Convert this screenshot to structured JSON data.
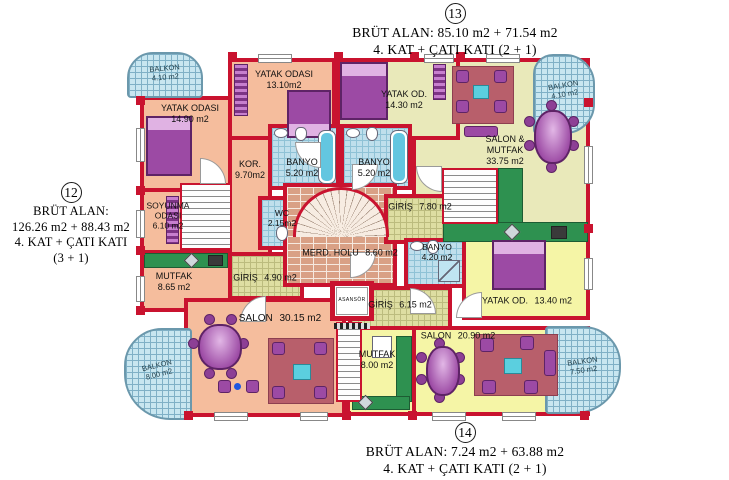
{
  "titles": {
    "top": {
      "number": "13",
      "line1": "BRÜT ALAN: 85.10 m2 + 71.54 m2",
      "line2": "4. KAT + ÇATI KATI  (2 + 1)"
    },
    "left": {
      "number": "12",
      "line1": "BRÜT ALAN:",
      "line2": "126.26 m2 + 88.43 m2",
      "line3": "4. KAT + ÇATI KATI",
      "line4": "(3 + 1)"
    },
    "bottom": {
      "number": "14",
      "line1": "BRÜT ALAN: 7.24 m2 + 63.88 m2",
      "line2": "4. KAT + ÇATI KATI  (2 + 1)"
    }
  },
  "rooms": {
    "balkon_tl": {
      "name": "BALKON",
      "area": "4.10 m2"
    },
    "balkon_tr": {
      "name": "BALKON",
      "area": "4.10 m2"
    },
    "balkon_bl": {
      "name": "BALKON",
      "area": "8.00 m2"
    },
    "balkon_br": {
      "name": "BALKON",
      "area": "7.50 m2"
    },
    "yatak_odasi_1490": {
      "name": "YATAK ODASI",
      "area": "14.90 m2"
    },
    "yatak_odasi_1310": {
      "name": "YATAK ODASI",
      "area": "13.10m2"
    },
    "banyo_sol": {
      "name": "BANYO",
      "area": "5.20 m2"
    },
    "banyo_sag": {
      "name": "BANYO",
      "area": "5.20 m2"
    },
    "kor": {
      "name": "KOR.",
      "area": "9.70m2"
    },
    "soyunma_odasi": {
      "name": "SOYUNMA ODASI",
      "area": "6.10 m2"
    },
    "wc": {
      "name": "WC",
      "area": "2.15m2"
    },
    "yatak_od_1430": {
      "name": "YATAK OD.",
      "area": "14.30 m2"
    },
    "salon_mutfak": {
      "name": "SALON & MUTFAK",
      "area": "33.75 m2"
    },
    "giris_780": {
      "name": "GİRİŞ",
      "area": "7.80 m2"
    },
    "merd_holu": {
      "name": "MERD. HOLU",
      "area": "8.60 m2"
    },
    "banyo_420": {
      "name": "BANYO",
      "area": "4.20 m2"
    },
    "mutfak_865": {
      "name": "MUTFAK",
      "area": "8.65 m2"
    },
    "giris_490": {
      "name": "GİRİŞ",
      "area": "4.90 m2"
    },
    "asansor": {
      "name": "ASANSÖR"
    },
    "giris_615": {
      "name": "GİRİŞ",
      "area": "6.15 m2"
    },
    "yatak_od_1340": {
      "name": "YATAK OD.",
      "area": "13.40 m2"
    },
    "salon_3015": {
      "name": "SALON",
      "area": "30.15 m2"
    },
    "mutfak_800": {
      "name": "MUTFAK",
      "area": "8.00 m2"
    },
    "salon_2090": {
      "name": "SALON",
      "area": "20.90 m2"
    }
  },
  "colors": {
    "wall_red": "#c9132f",
    "floor_salmon": "#f5bd9d",
    "floor_olive": "#e9e9ba",
    "floor_yellow": "#f5f5a6",
    "tile_blue": "#bfdfec",
    "tile_khaki": "#dedea2",
    "balcony_blue": "#c8e6f0",
    "counter_green": "#2e9150",
    "furniture_purple": "#9c4aa4",
    "rug_rose": "#b85f6b"
  }
}
